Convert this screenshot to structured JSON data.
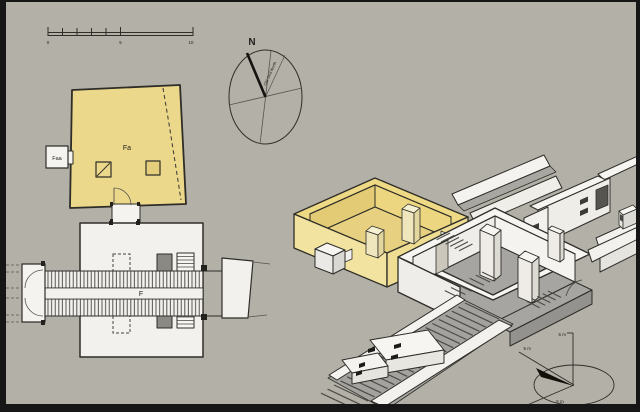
{
  "figure": {
    "background_color": "#b3b0a7",
    "frame_color": "#161616",
    "description_visible_labels_only": true
  },
  "scale_bar": {
    "tick_labels": [
      "0",
      "5",
      "10"
    ]
  },
  "compass": {
    "north_label": "N",
    "grid_north_label": "Old Grid North"
  },
  "plan_view": {
    "chapel_label": "Fa",
    "annex_label": "Faa",
    "corridor_label": "F"
  },
  "isometric_view": {
    "axis_labels": {
      "vertical": "5 m",
      "northwest": "5 m",
      "southwest": "5 m"
    }
  },
  "colors": {
    "chapel_yellow": "#ecd88a",
    "chapel_yellow_light": "#f3e6a6",
    "chapel_yellow_dark": "#dfc772",
    "structure_white": "#f4f3f0",
    "structure_shade": "#e2e0da",
    "floor_gray": "#a6a5a1",
    "outline": "#2e2d28"
  }
}
